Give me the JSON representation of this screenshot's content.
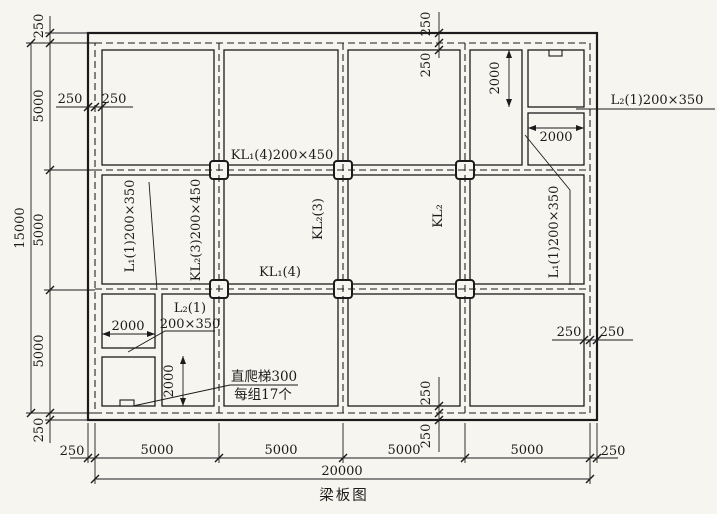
{
  "title": "梁板图",
  "beam_labels": {
    "kl1_top": "KL₁(4)200×450",
    "kl1_mid": "KL₁(4)",
    "kl2_3_full": "KL₂(3)200×450",
    "kl2_3": "KL₂(3)",
    "kl2": "KL₂",
    "l1_left": "L₁(1)200×350",
    "l1_right": "L₁(1)200×350",
    "l2_top_right": "L₂(1)200×350",
    "l2_bottom_left_line1": "L₂(1)",
    "l2_bottom_left_line2": "200×350"
  },
  "annotations": {
    "ladder_line1": "直爬梯300",
    "ladder_line2": "每组17个"
  },
  "dimensions": {
    "left_chain": [
      "250",
      "5000",
      "5000",
      "5000",
      "250"
    ],
    "left_total": "15000",
    "bottom_chain": [
      "250",
      "5000",
      "5000",
      "5000",
      "5000",
      "250"
    ],
    "bottom_total": "20000",
    "top_left_pair": [
      "250",
      "250"
    ],
    "top_center_pair": [
      "250",
      "250"
    ],
    "bottom_center_pair": [
      "250",
      "250"
    ],
    "right_middle_pair": [
      "250",
      "250"
    ],
    "room_dims": {
      "top_right_vertical": "2000",
      "top_right_horizontal": "2000",
      "bottom_left_horizontal": "2000",
      "bottom_left_vertical": "2000"
    }
  }
}
